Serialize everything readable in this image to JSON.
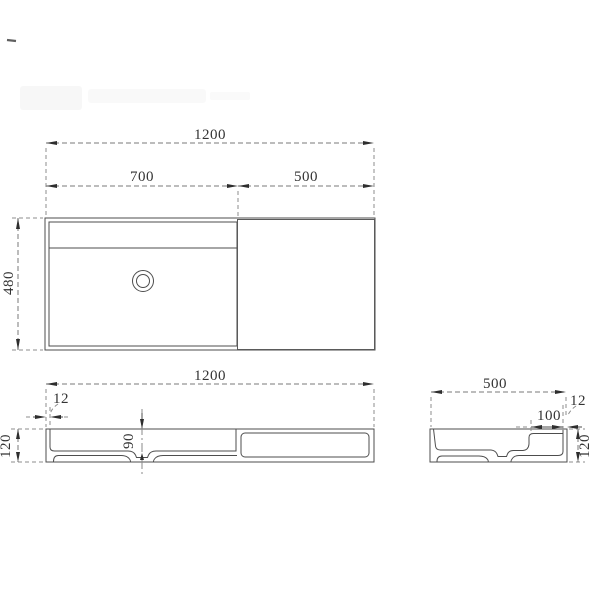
{
  "drawing": {
    "type": "technical-dimension-drawing",
    "background": "#ffffff",
    "line_color": "#4d4d4d",
    "dash_color": "#808080",
    "text_color": "#333333",
    "views": {
      "top": {
        "overall_width": "1200",
        "basin_width": "700",
        "deck_width": "500",
        "overall_depth": "480"
      },
      "front": {
        "overall_width": "1200",
        "wall_thickness": "12",
        "basin_depth": "90",
        "overall_height": "120"
      },
      "side": {
        "overall_depth": "500",
        "wall_thickness": "12",
        "deck_ledge": "100",
        "overall_height": "120"
      }
    }
  }
}
